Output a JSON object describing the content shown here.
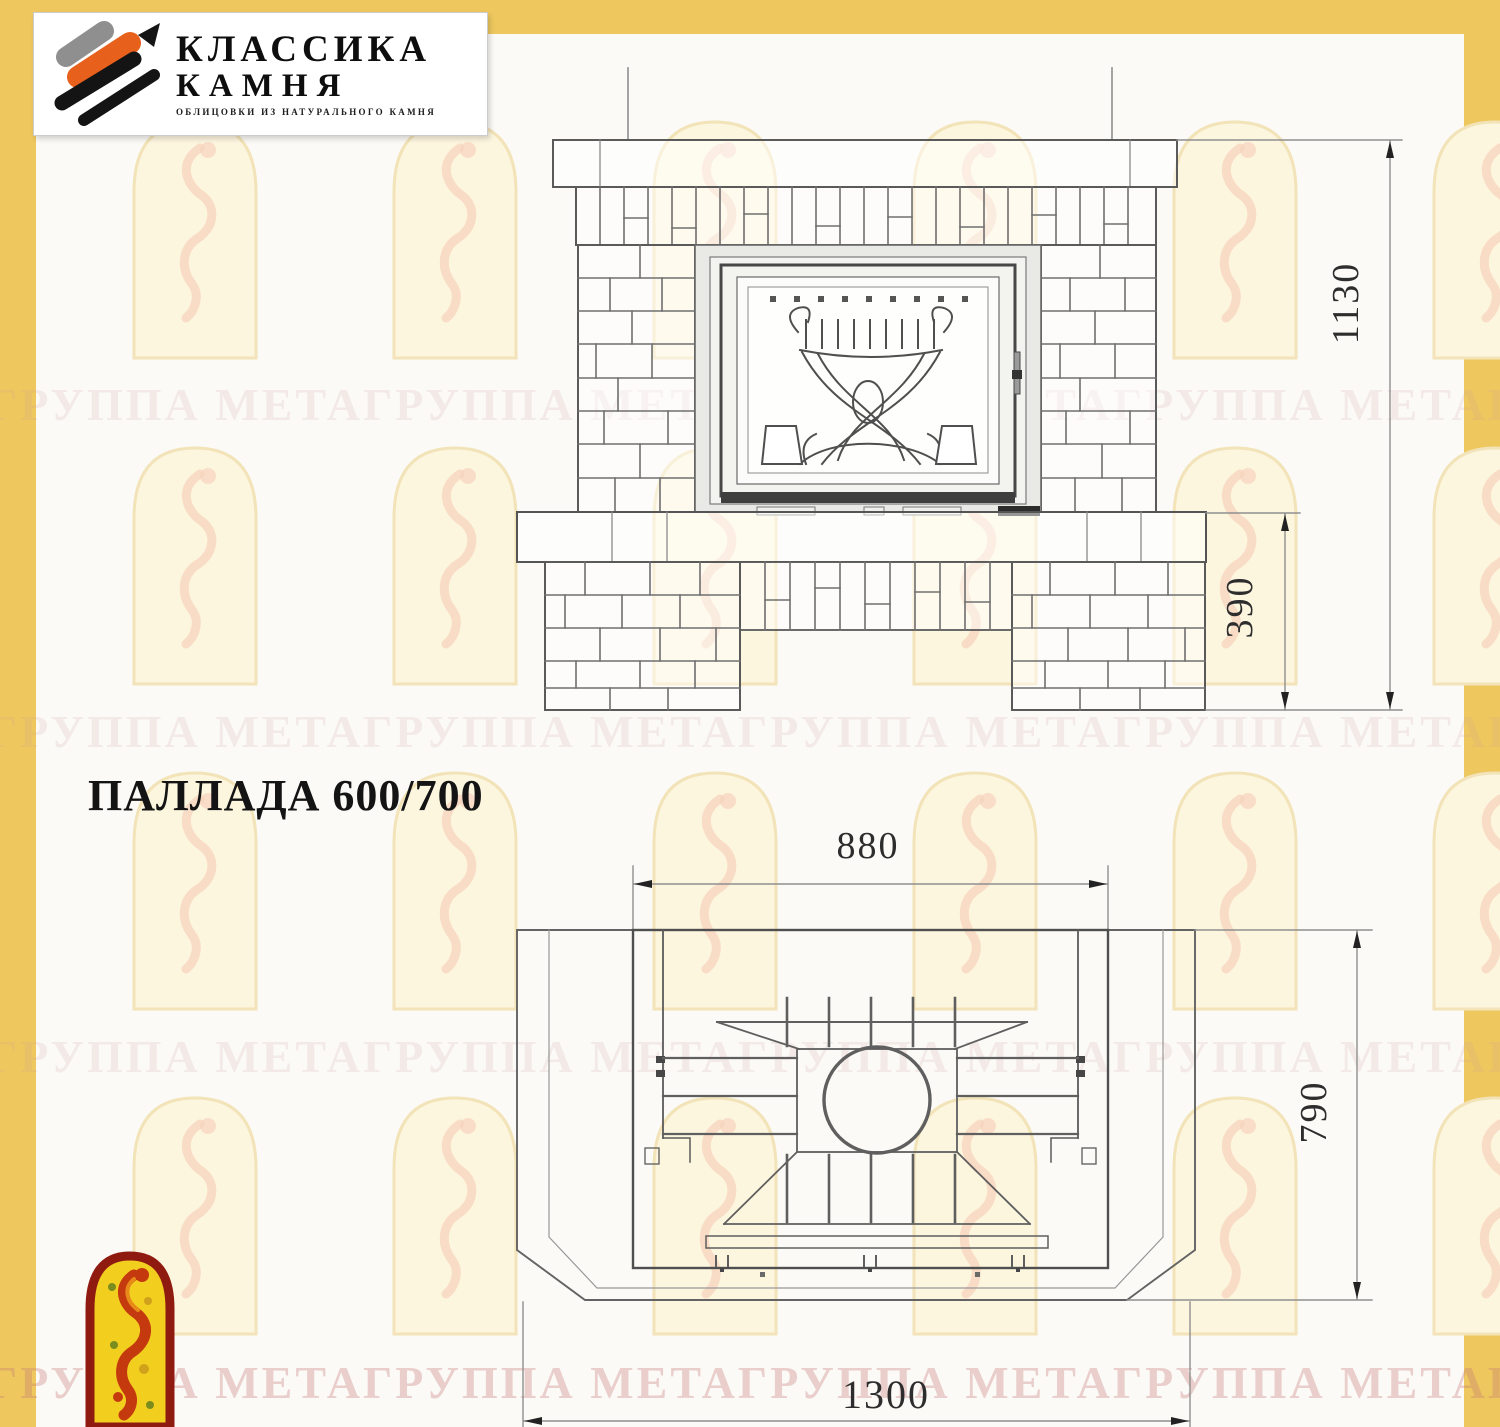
{
  "company_logo": {
    "icon": "stone-strokes-icon",
    "title_line1": "КЛАССИКА",
    "title_line2": "КАМНЯ",
    "subtitle": "ОБЛИЦОВКИ ИЗ НАТУРАЛЬНОГО КАМНЯ"
  },
  "model_title": "ПАЛЛАДА 600/700",
  "watermark": {
    "text": "ГРУППА МЕТАГРУППА МЕТАГРУППА МЕТАГРУППА МЕТАГРУППА МЕТА",
    "arch_icon": "meta-arch-watermark-icon"
  },
  "front_view": {
    "name": "front elevation of fireplace",
    "dimensions": {
      "total_height": "1130",
      "base_height": "390"
    }
  },
  "plan_view": {
    "name": "top plan of fireplace",
    "dimensions": {
      "body_width": "880",
      "depth": "790",
      "total_width": "1300"
    }
  },
  "bottom_logo": {
    "icon": "meta-arch-logo"
  },
  "colors": {
    "accent_yellow": "#eec85e",
    "logo_orange": "#e8611c",
    "logo_black": "#141414",
    "meta_red": "#8f1a10",
    "meta_yellow": "#f2ce1f",
    "watermark_pink": "#cf9999",
    "line_gray": "#555555"
  }
}
